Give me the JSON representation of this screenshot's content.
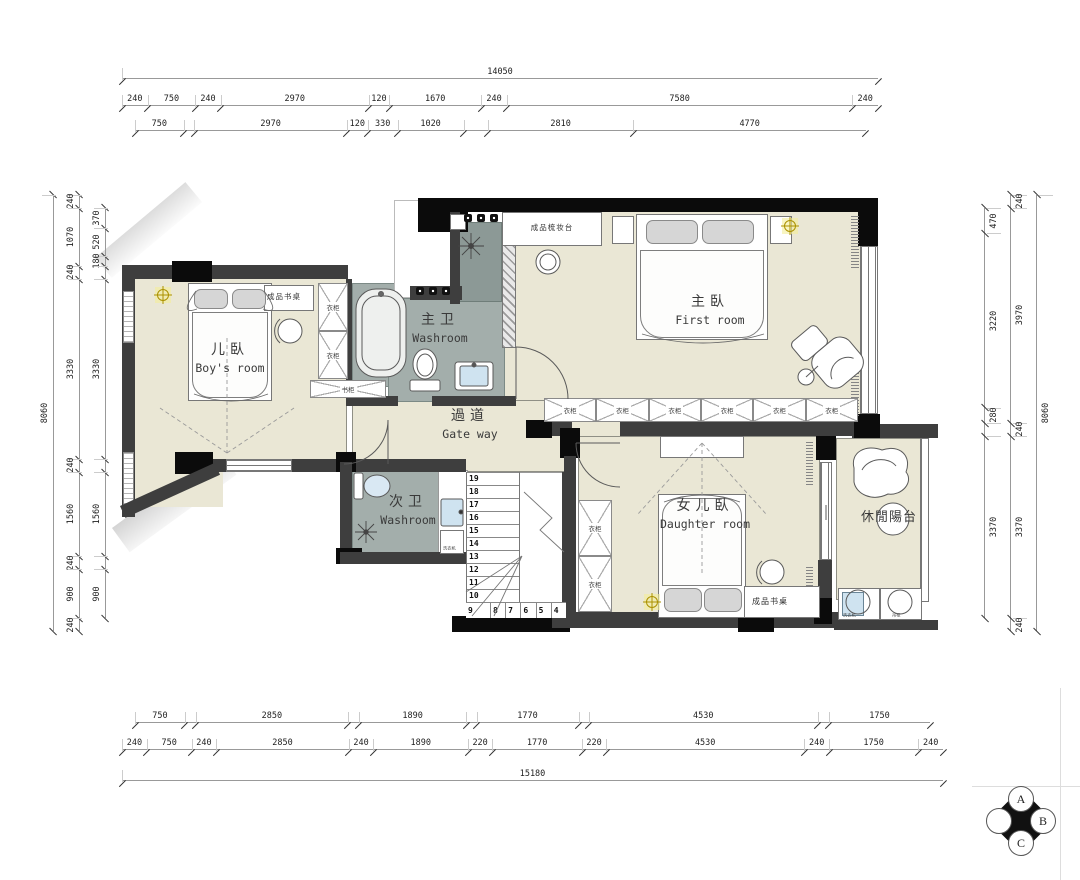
{
  "rooms": {
    "boys": {
      "zh": "儿臥",
      "en": "Boy's room"
    },
    "master_bath": {
      "zh": "主卫",
      "en": "Washroom"
    },
    "master": {
      "zh": "主臥",
      "en": "First room"
    },
    "corridor": {
      "zh": "過道",
      "en": "Gate way"
    },
    "second_bath": {
      "zh": "次卫",
      "en": "Washroom"
    },
    "daughter": {
      "zh": "女儿臥",
      "en": "Daughter room"
    },
    "balcony": {
      "zh": "休閒陽台",
      "en": ""
    }
  },
  "furniture": {
    "desk": "成品书桌",
    "wardrobe": "衣柜",
    "bookcase": "书柜",
    "dresser": "成品梳妆台",
    "washer": "洗衣机",
    "hang_cabinet": "吊柜"
  },
  "stairs": {
    "upper": [
      "19",
      "18",
      "17",
      "16",
      "15",
      "14",
      "13",
      "12",
      "11",
      "10"
    ],
    "lower": [
      "9",
      "8",
      "7",
      "6",
      "5",
      "4"
    ]
  },
  "compass": {
    "n": "A",
    "e": "B",
    "s": "C",
    "w": "D"
  },
  "dims": {
    "top": [
      [
        14050
      ],
      [
        240,
        750,
        240,
        2970,
        120,
        1670,
        240,
        7580,
        240
      ],
      [
        750,
        {
          "v": 240,
          "l": ""
        },
        2970,
        120,
        330,
        1020,
        {
          "v": 550,
          "l": ""
        },
        2810,
        4770
      ]
    ],
    "bottom": [
      [
        750,
        {
          "v": 240,
          "l": ""
        },
        2850,
        {
          "v": 240,
          "l": ""
        },
        1890,
        {
          "v": 220,
          "l": ""
        },
        1770,
        {
          "v": 220,
          "l": ""
        },
        4530,
        {
          "v": 240,
          "l": ""
        },
        1750
      ],
      [
        240,
        750,
        240,
        2850,
        240,
        1890,
        220,
        1770,
        220,
        4530,
        240,
        1750,
        240
      ],
      [
        15180
      ]
    ],
    "left": [
      [
        8060
      ],
      [
        240,
        1070,
        240,
        3330,
        240,
        1560,
        240,
        900,
        240
      ],
      [
        370,
        520,
        180,
        {
          "v": 240,
          "l": ""
        },
        3330,
        {
          "v": 240,
          "l": ""
        },
        1560,
        {
          "v": 240,
          "l": ""
        },
        900
      ]
    ],
    "right": [
      [
        470,
        3220,
        280,
        {
          "v": 240,
          "l": ""
        },
        3370
      ],
      [
        240,
        3970,
        240,
        3370,
        240
      ],
      [
        8060
      ]
    ]
  },
  "colors": {
    "floor": "#eae7d5",
    "bath_floor": "#a3aeab",
    "shower_floor": "#8c9996",
    "wall": "#3e3e3e",
    "column": "#0b0b0b",
    "light_symbol": "#b89b00",
    "basin": "#cfe3f0"
  }
}
